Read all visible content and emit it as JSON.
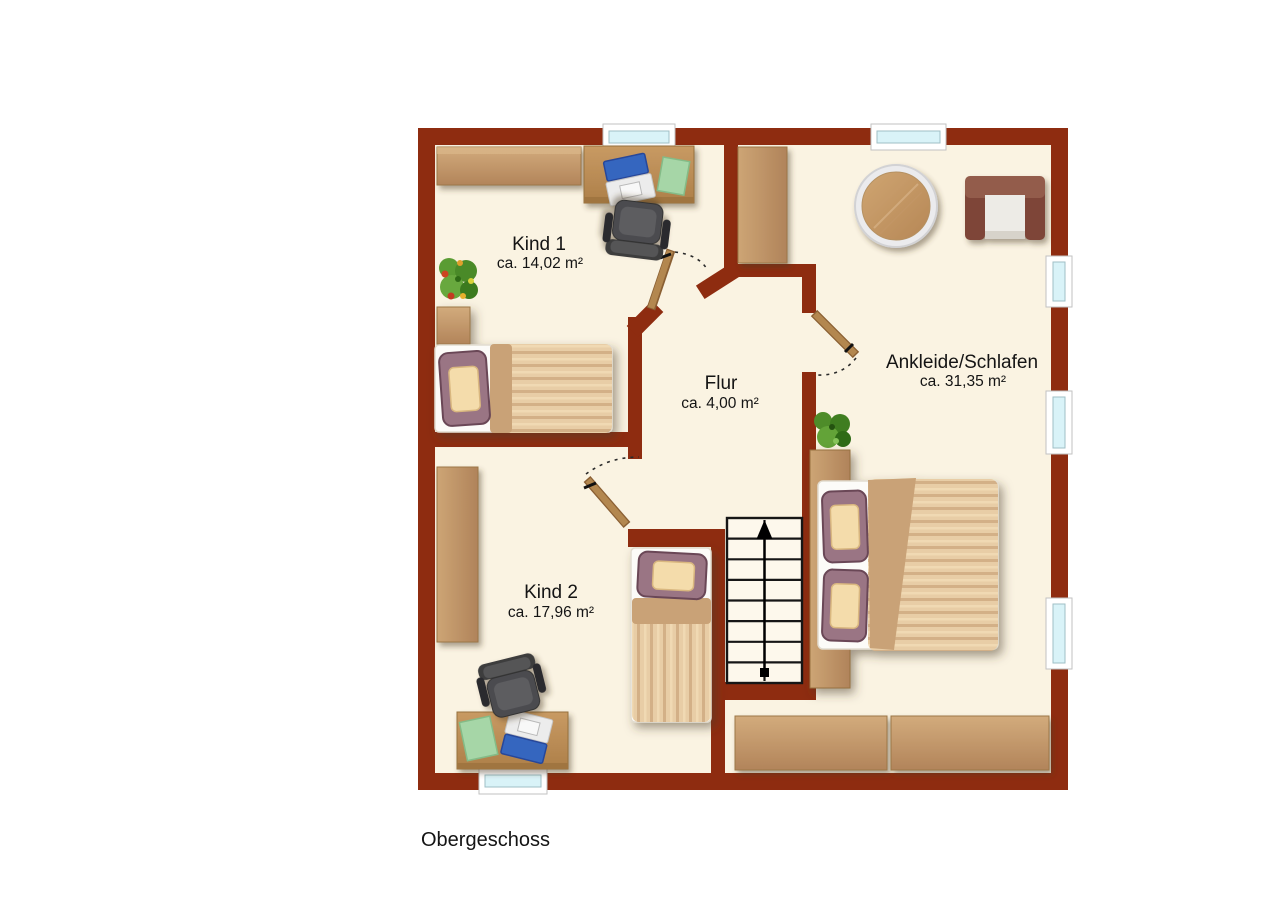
{
  "title": "Obergeschoss",
  "rooms": {
    "kind1": {
      "name": "Kind 1",
      "area": "ca. 14,02 m²"
    },
    "kind2": {
      "name": "Kind 2",
      "area": "ca. 17,96 m²"
    },
    "flur": {
      "name": "Flur",
      "area": "ca. 4,00 m²"
    },
    "ankleide": {
      "name": "Ankleide/Schlafen",
      "area": "ca. 31,35 m²"
    }
  },
  "colors": {
    "wall": "#8e2c10",
    "floor": "#faf3e2",
    "window_glass": "#d9f3f8",
    "wood_light": "#c9a273",
    "stairs_fill": "#fdf8ec",
    "laptop_screen": "#3566bf",
    "armchair": "#8e574a"
  },
  "furniture": {
    "kind1": [
      "wardrobe",
      "desk",
      "laptop",
      "office-chair",
      "plant",
      "single-bed"
    ],
    "kind2": [
      "wardrobe",
      "desk",
      "laptop",
      "office-chair",
      "single-bed"
    ],
    "flur": [
      "staircase-up"
    ],
    "ankleide": [
      "wardrobe",
      "round-table",
      "armchair",
      "plant",
      "double-bed",
      "sideboard-left",
      "sideboard-right"
    ]
  },
  "openings": {
    "windows": [
      "top-wall-kind1",
      "top-wall-ankleide",
      "right-wall-upper",
      "right-wall-middle",
      "right-wall-lower",
      "bottom-wall-kind2"
    ],
    "doors": [
      "kind1-door",
      "ankleide-door",
      "kind2-door"
    ]
  }
}
